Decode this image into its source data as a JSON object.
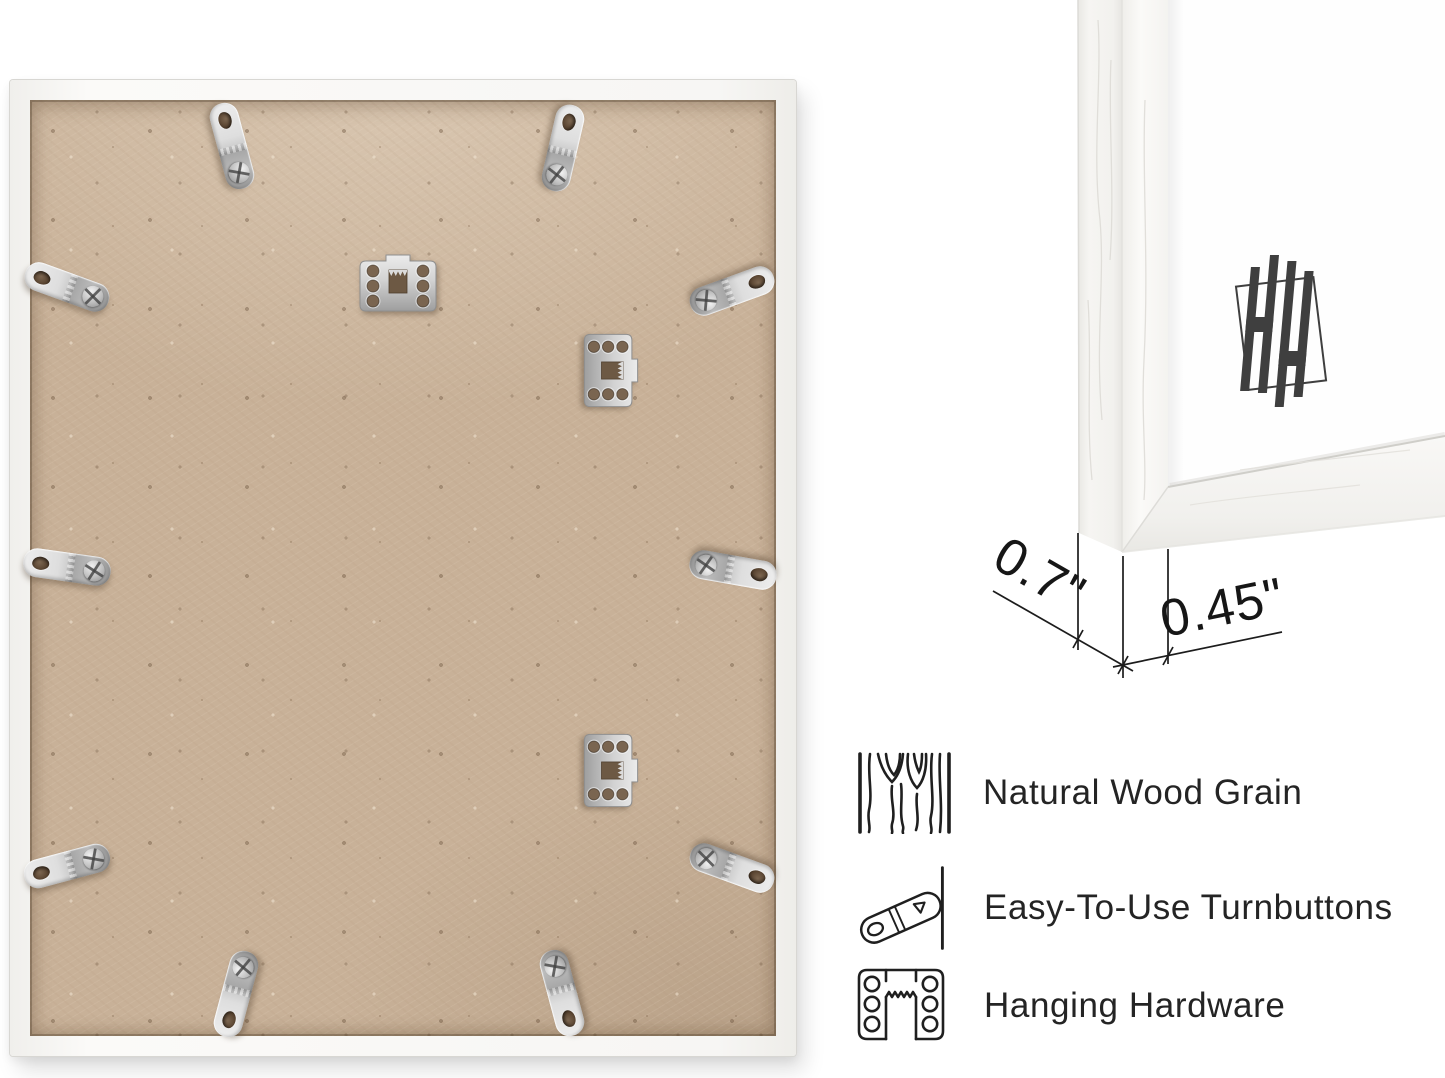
{
  "canvas": {
    "background": "#ffffff"
  },
  "product_photos": {
    "back_view": {
      "frame_color": "#f7f6f4",
      "backing_color": "#c8b198",
      "hardware_color": "#d6d6d6",
      "turnbutton_count": 10,
      "sawtooth_hanger_count": 3
    },
    "corner_view": {
      "frame_color": "#f7f6f4",
      "monogram": "HH",
      "monogram_color": "#3f3f3f"
    }
  },
  "measurements": {
    "frame_depth": "0.7\"",
    "frame_face_width": "0.45\""
  },
  "features": {
    "text_color": "#242424",
    "items": [
      {
        "icon": "wood-grain-icon",
        "label": "Natural Wood Grain"
      },
      {
        "icon": "turnbutton-icon",
        "label": "Easy-To-Use Turnbuttons"
      },
      {
        "icon": "hanging-hardware-icon",
        "label": "Hanging Hardware"
      }
    ]
  }
}
